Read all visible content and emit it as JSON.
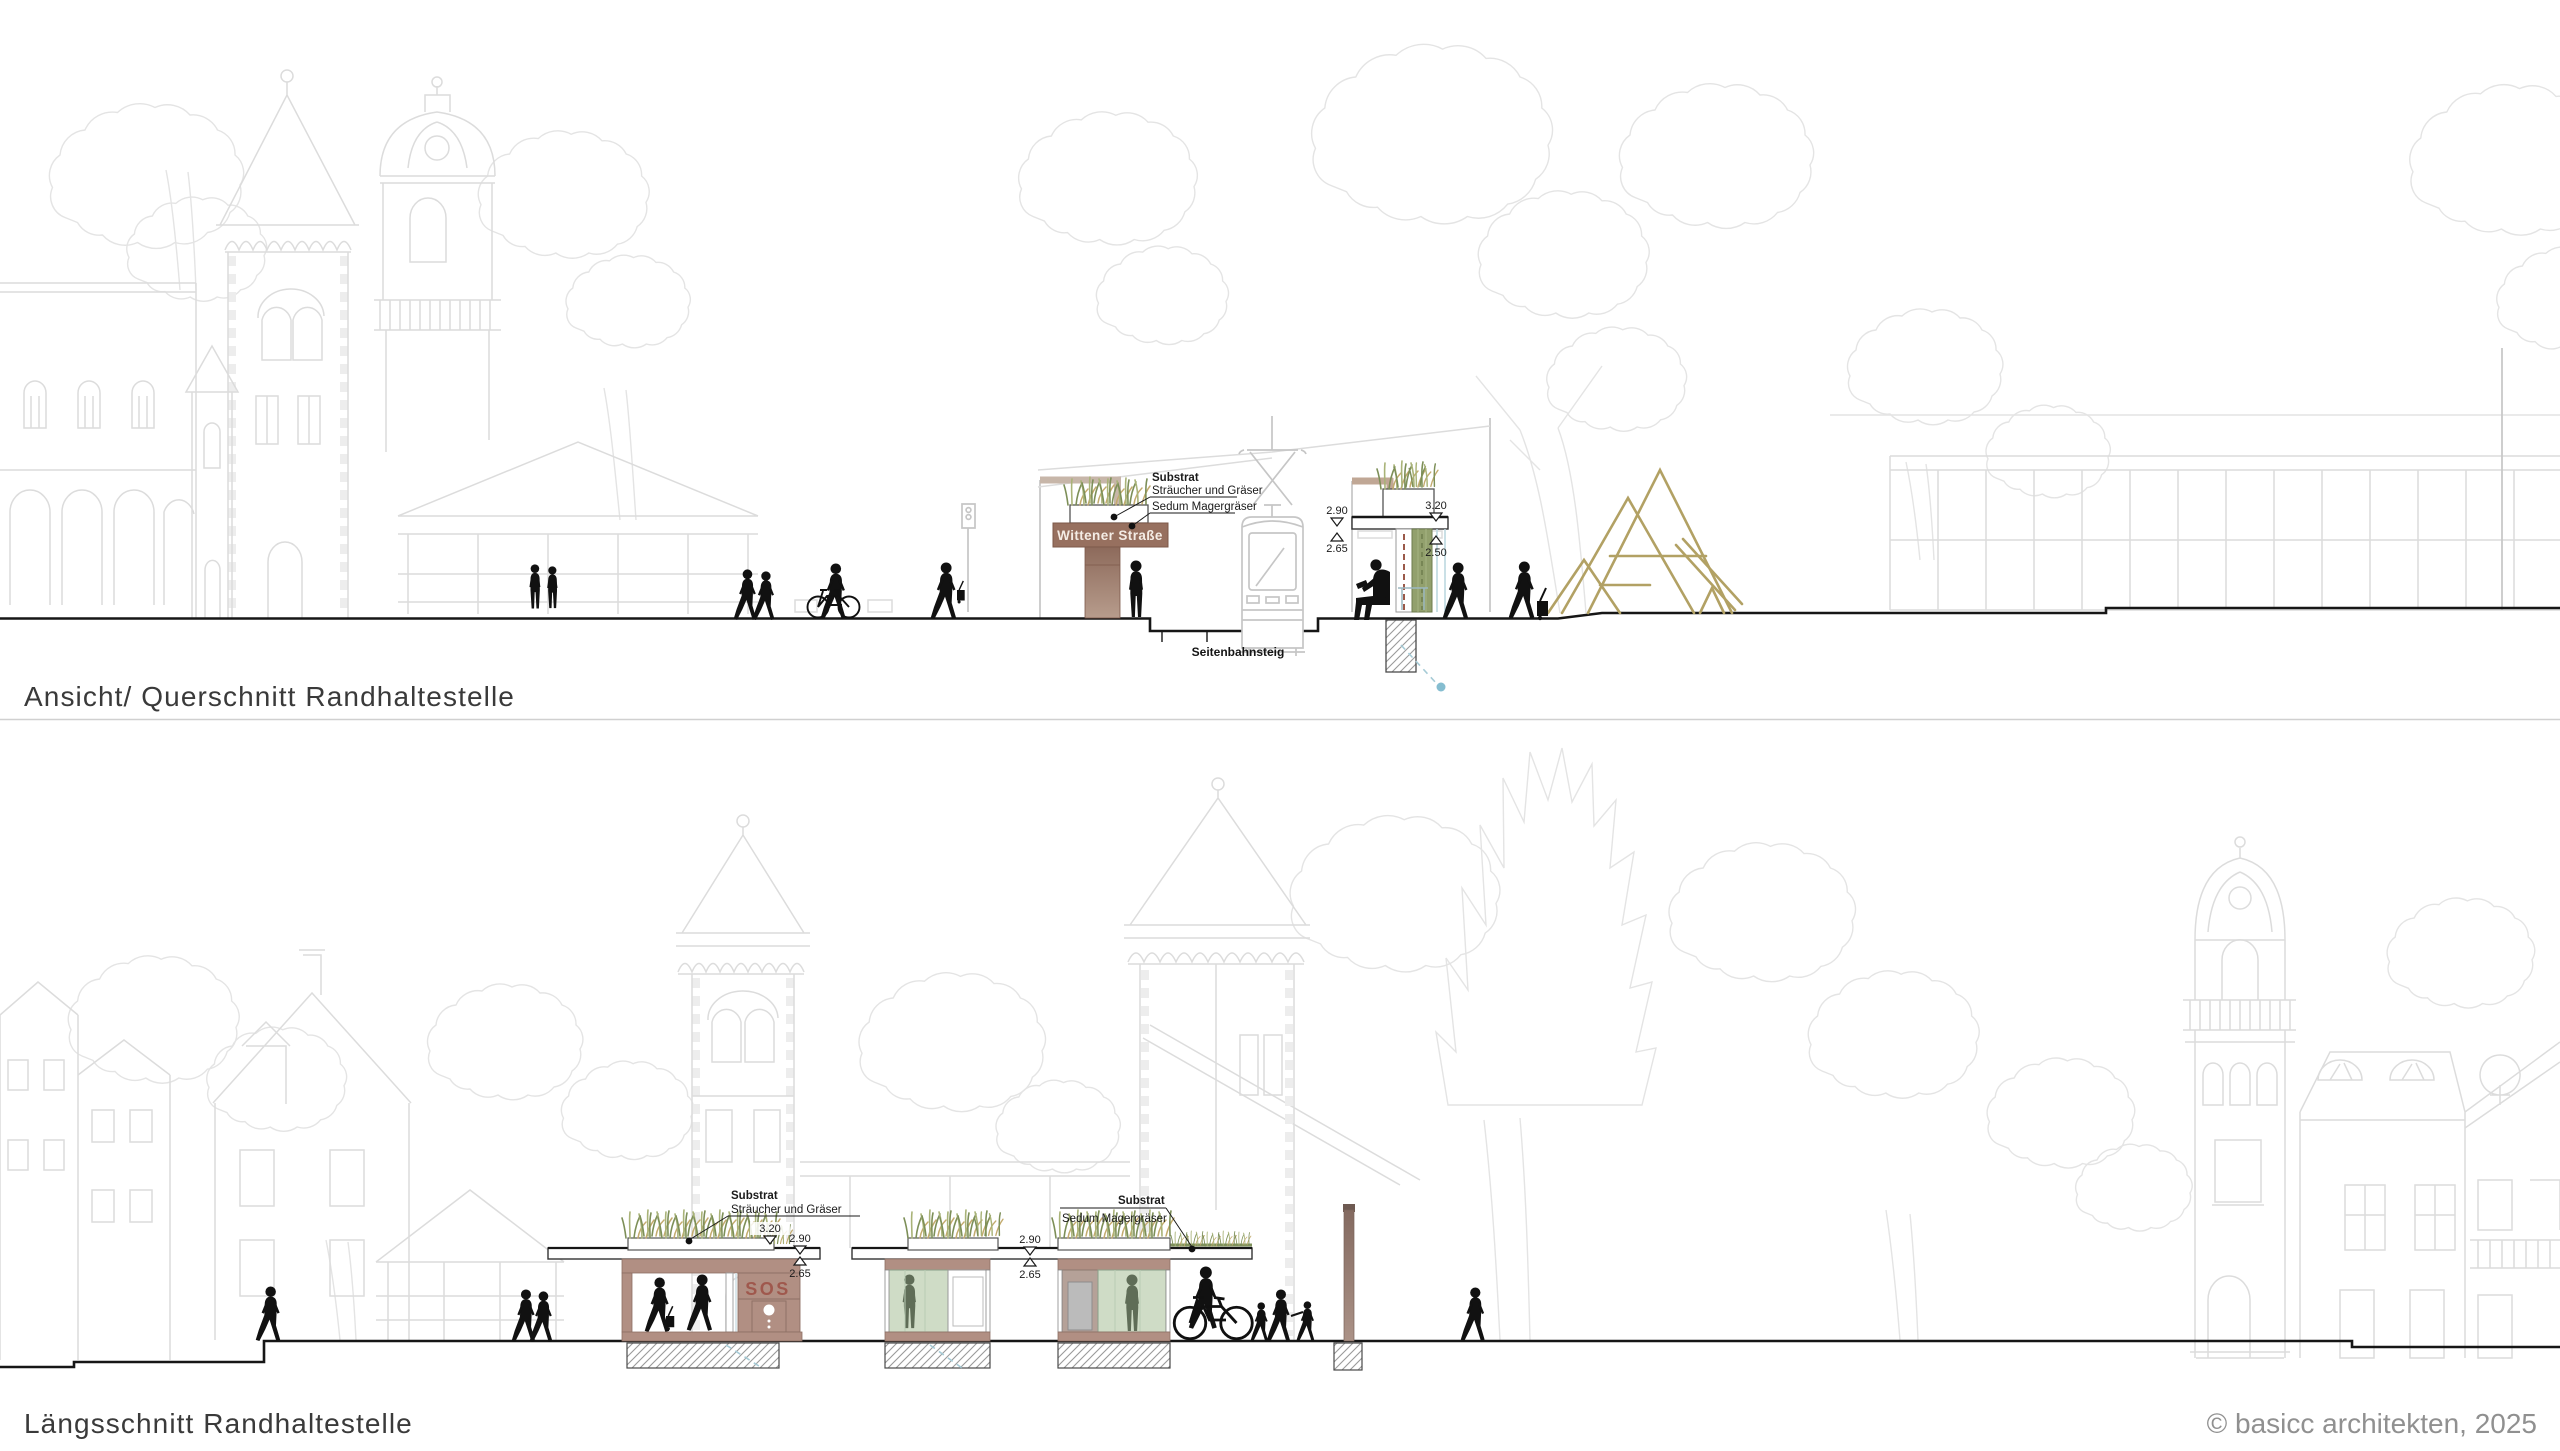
{
  "document": {
    "credit": "© basicc architekten, 2025"
  },
  "sections": {
    "querschnitt": {
      "title": "Ansicht/ Querschnitt Randhaltestelle",
      "station_sign": "Wittener Straße",
      "platform_label": "Seitenbahnsteig",
      "annotation": {
        "title": "Substrat",
        "line1": "Sträucher und Gräser",
        "line2": "Sedum Magergräser"
      },
      "dimensions": {
        "left_upper": "2.90",
        "left_lower": "2.65",
        "right_upper": "3.20",
        "right_lower": "2.50"
      }
    },
    "laengsschnitt": {
      "title": "Längsschnitt Randhaltestelle",
      "shelter_closed": {
        "annotation_title": "Substrat",
        "annotation_line1": "Sträucher und Gräser",
        "roof_dimension": "3.20",
        "dimension_upper": "2.90",
        "dimension_lower": "2.65",
        "sos_label": "SOS"
      },
      "shelter_glass": {
        "annotation_title": "Substrat",
        "annotation_line1": "Sedum Magergräser",
        "dimension_upper": "2.90",
        "dimension_lower": "2.65"
      }
    }
  },
  "palette": {
    "line_art": "#dcdcdc",
    "tram_outline": "#c6c6c6",
    "ink": "#161616",
    "structure_brown": "#9a7263",
    "fascia_brown": "#b18f83",
    "green_panel": "#92a06d",
    "glass_green": "#cfdcc6",
    "glass_silhouette": "#5f6d57",
    "playground_tan": "#b2a164",
    "marker_blue": "#85bdd0",
    "credit_grey": "#909090"
  }
}
